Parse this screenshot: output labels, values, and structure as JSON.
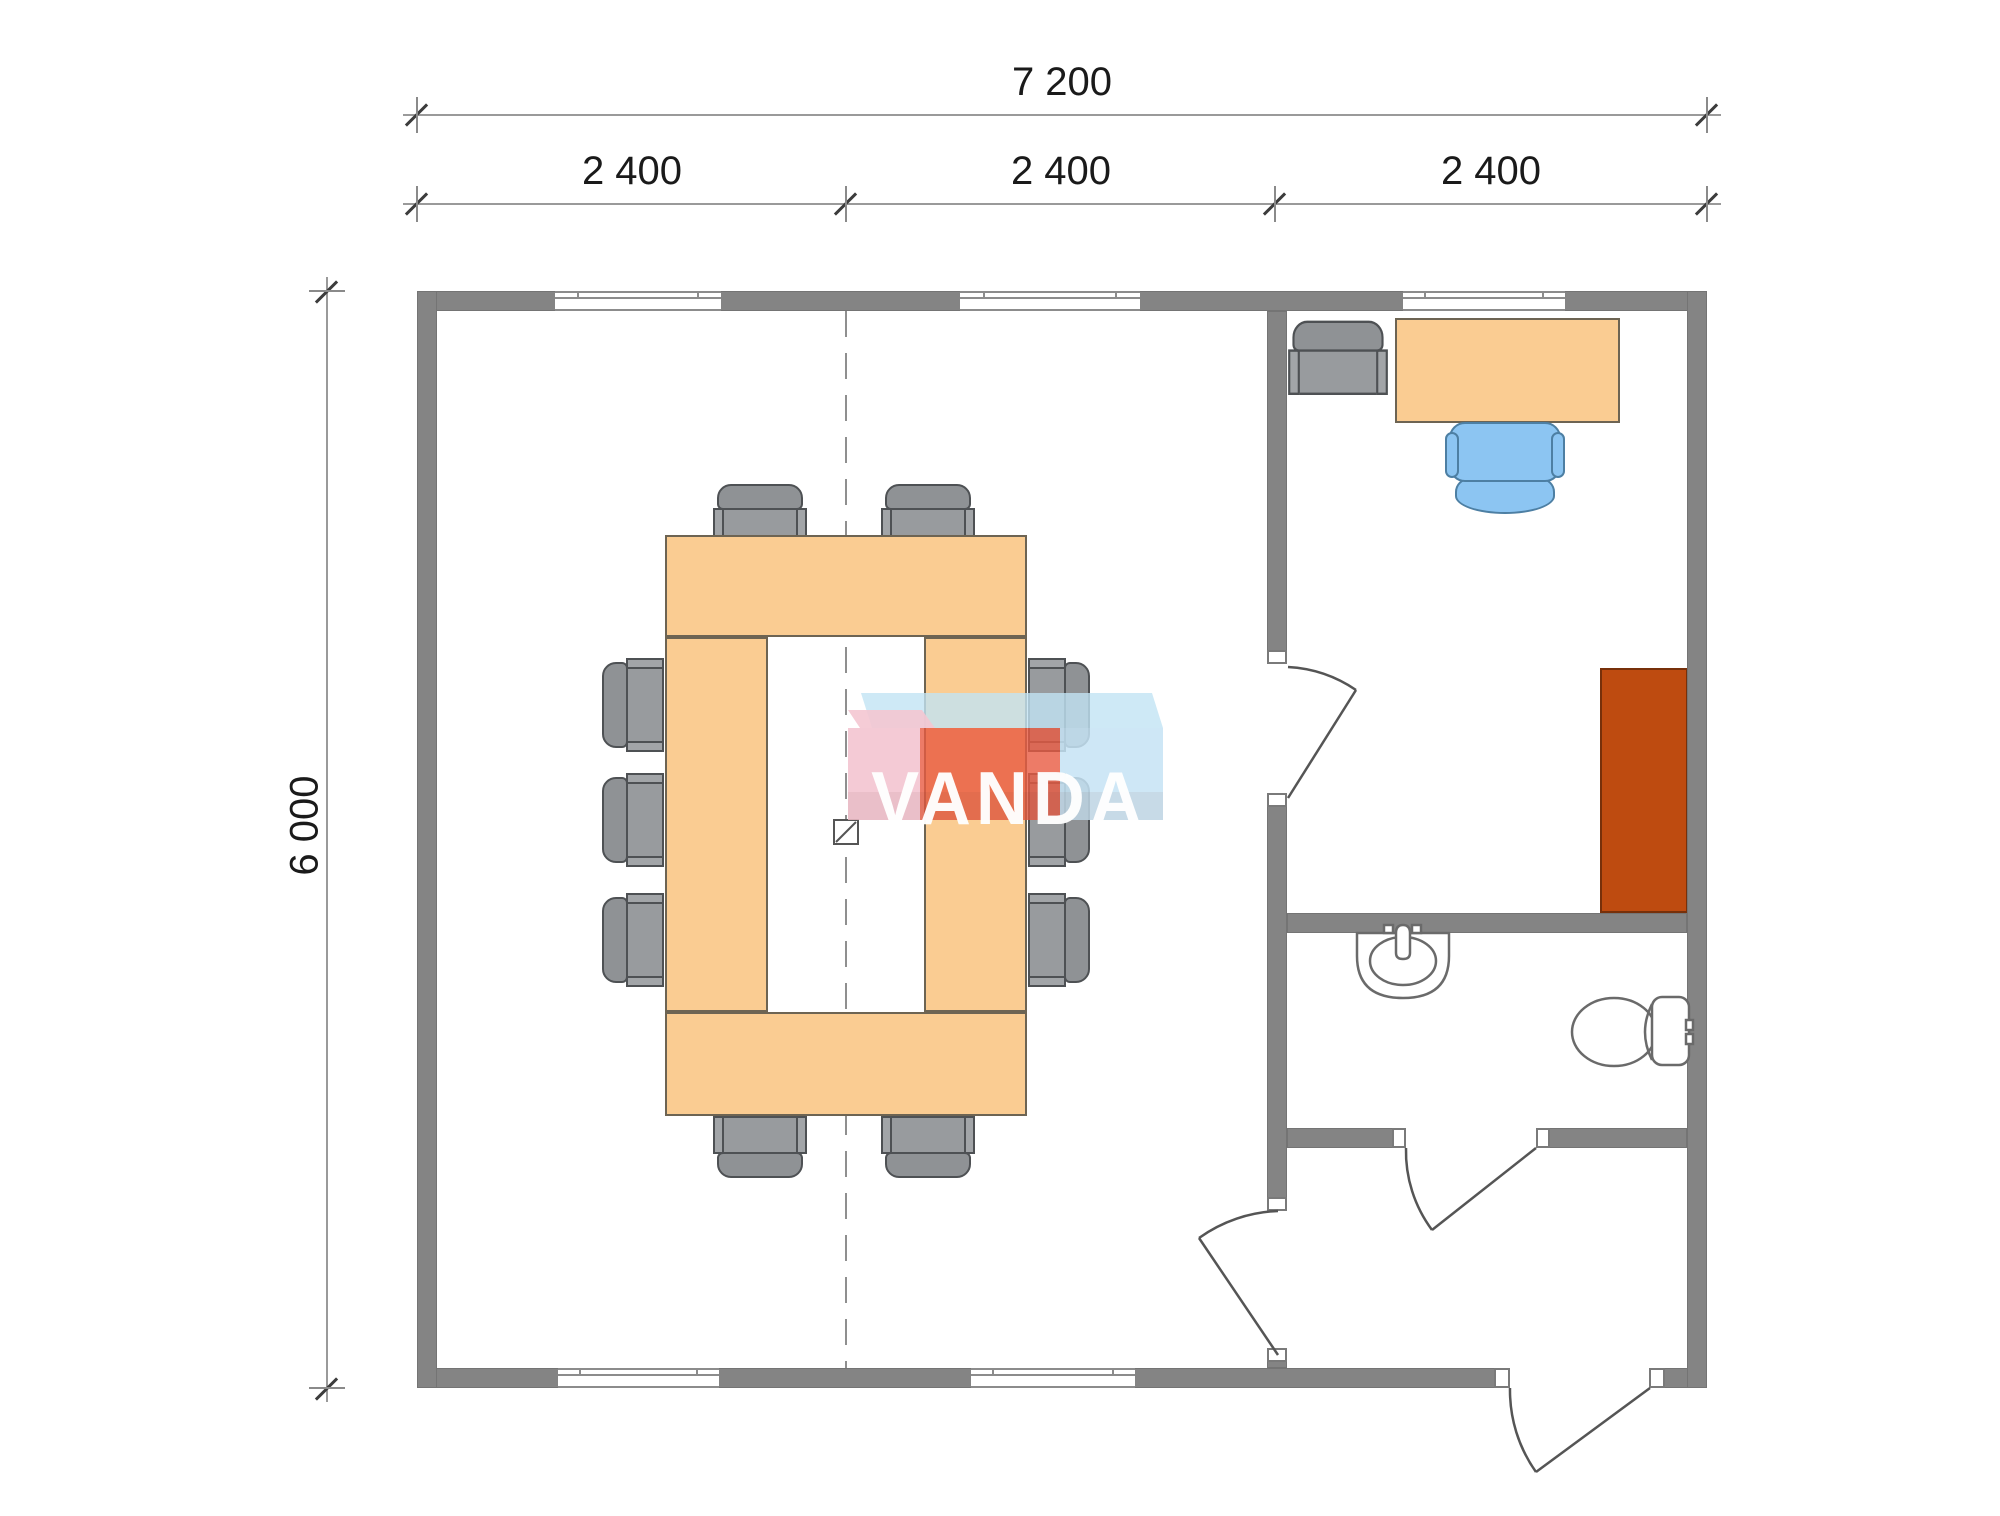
{
  "canvas": {
    "width": 2000,
    "height": 1516,
    "background": "#ffffff"
  },
  "dimensions": {
    "top_total": {
      "label": "7 200"
    },
    "top_modules": [
      {
        "label": "2 400"
      },
      {
        "label": "2 400"
      },
      {
        "label": "2 400"
      }
    ],
    "left_height": {
      "label": "6 000"
    }
  },
  "watermark": {
    "text": "VANDA",
    "text_color": "#FFFFFF",
    "front_colors": [
      "#F2C3CF",
      "#E85A41",
      "#C5E3F5"
    ],
    "top_colors": [
      "#F4C7D2",
      "#C2E4F4"
    ]
  },
  "palette": {
    "wall": "#848484",
    "wood_furniture": "#FACC92",
    "wood_border": "#6D6453",
    "chair_gray": "#8F9295",
    "chair_blue": "#8CC5F2",
    "cabinet_red": "#BE4B10",
    "dimension_text": "#1A1A1A",
    "dimension_line": "#9A9A9A",
    "centerline": "#8F8F8F",
    "fixture_outline": "#6A6A6A"
  },
  "furniture": {
    "conference_chairs_count": 10,
    "items": [
      "conference-table",
      "office-desk",
      "desk-chair-blue",
      "office-armchair",
      "cabinet",
      "sink",
      "toilet"
    ]
  }
}
